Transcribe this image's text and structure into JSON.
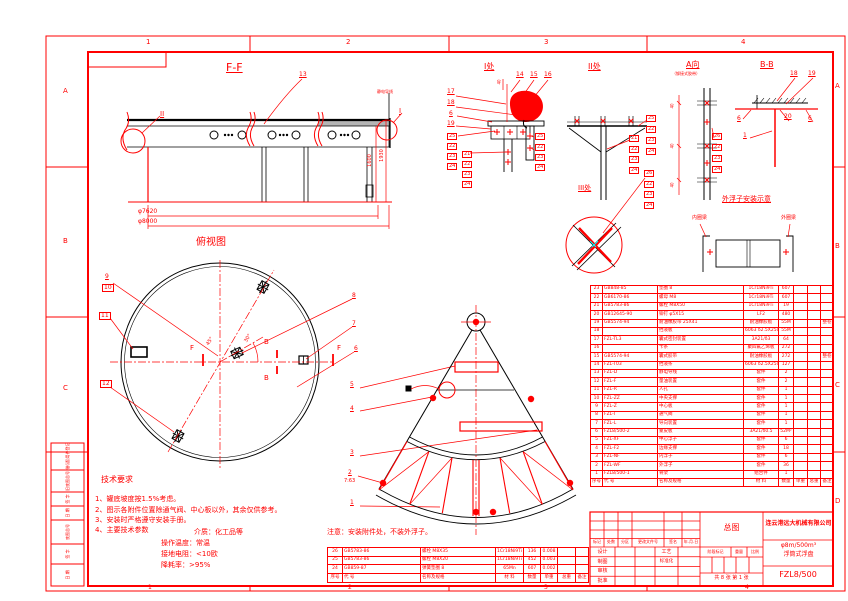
{
  "sheet": {
    "zones_top": [
      "1",
      "2",
      "3",
      "4"
    ],
    "zones_bottom": [
      "1",
      "2",
      "3",
      "4"
    ],
    "zones_left": [
      "A",
      "B",
      "C"
    ],
    "zones_right": [
      "A",
      "B",
      "C",
      "D"
    ],
    "left_strip": [
      "借(通)用件登记",
      "旧底图总号",
      "签 字",
      "日 期",
      "底图总号",
      "签 字",
      "日 期"
    ]
  },
  "views": {
    "ff": {
      "title": "F-F",
      "c13": "13",
      "cII": "II",
      "cI": "I",
      "wire": "静电导线",
      "dim1600": "1600",
      "dim1930": "1930",
      "dia7620": "φ7620",
      "dia8000": "φ8000"
    },
    "plan": {
      "title": "俯视图",
      "c9": "9",
      "c10": "10",
      "c11": "11",
      "c12": "12",
      "c8": "8",
      "c7": "7",
      "c6": "6",
      "c5": "5",
      "c4": "4",
      "c3": "3",
      "c2": "2",
      "c2sub": "7:63",
      "c1": "1",
      "f": "F",
      "b": "B",
      "a30": "30°",
      "a45": "45°"
    },
    "d1": {
      "title": "I处",
      "dim40": "40",
      "c14": "14",
      "c15": "15",
      "c16": "16",
      "c17": "17",
      "c18": "18",
      "c6": "6",
      "c19": "19",
      "sL": [
        "25",
        "22",
        "23",
        "24"
      ],
      "sM": [
        "21",
        "22",
        "23",
        "24"
      ],
      "sR": [
        "25",
        "22",
        "23",
        "24"
      ]
    },
    "d2": {
      "title": "II处",
      "sA": [
        "25",
        "22",
        "23",
        "24"
      ],
      "sB": [
        "21",
        "22",
        "23",
        "24"
      ]
    },
    "d3": {
      "title": "III处",
      "s": [
        "26",
        "22",
        "23",
        "24"
      ]
    },
    "da": {
      "title": "A向",
      "subtitle": "（铆接式胶带）",
      "dim40": "40",
      "s": [
        "26",
        "22",
        "23",
        "24"
      ]
    },
    "bb": {
      "title": "B-B",
      "c18": "18",
      "c19": "19",
      "c6a": "6",
      "c20": "20",
      "c6b": "6",
      "c1": "1"
    },
    "fl": {
      "title": "外浮子安装示意",
      "inner": "内圈梁",
      "outer": "外圈梁"
    }
  },
  "tech": {
    "heading": "技术要求",
    "items": [
      "1、罐底坡度按1.5%考虑。",
      "2、图示各附件位置除通气阀、中心板以外，其余仅供参考。",
      "3、安装时严格遵守安装手册。",
      "4、主要技术参数"
    ],
    "params": [
      "介质：化工品等",
      "操作温度：常温",
      "接地电阻：<10欧",
      "降耗率：>95%"
    ]
  },
  "note": "注意：安装附件处，不装外浮子。",
  "bom": {
    "headers": [
      "序号",
      "代  号",
      "名称及规格",
      "材  料",
      "数量",
      "单重",
      "总重",
      "备注"
    ],
    "rows": [
      [
        "23",
        "GB848-85",
        "垫圈 8",
        "1Cr18Ni9Ti",
        "607",
        "",
        "",
        ""
      ],
      [
        "22",
        "GB6170-86",
        "螺母 M8",
        "1Cr18Ni9Ti",
        "607",
        "",
        "",
        ""
      ],
      [
        "21",
        "GB5783-86",
        "螺栓 M8X50",
        "1Cr18Ni9Ti",
        "19",
        "",
        "",
        ""
      ],
      [
        "20",
        "GB12645-90",
        "铆钉 φ5X15",
        "LF2",
        "480",
        "",
        "",
        ""
      ],
      [
        "19",
        "GB5574-94",
        "耐油橡胶带 25X41",
        "耐油橡胶板",
        "55M",
        "",
        "",
        "整卷"
      ],
      [
        "18",
        "",
        "挡液板",
        "6063 δ2.5X250",
        "55M",
        "",
        "",
        ""
      ],
      [
        "17",
        "FZL-TL3",
        "囊式密封装置",
        "3A21/δ3",
        "64",
        "",
        "",
        ""
      ],
      [
        "16",
        "",
        "卡条",
        "聚四氟乙烯板",
        "272",
        "",
        "",
        ""
      ],
      [
        "15",
        "GB5574-94",
        "囊式胶带",
        "耐油橡胶板",
        "272",
        "",
        "",
        "整卷"
      ],
      [
        "14",
        "FZL-T03",
        "挡液条",
        "6063 δ2.5X250",
        "127",
        "",
        "",
        ""
      ],
      [
        "13",
        "FZL-D",
        "静电导线",
        "套件",
        "2",
        "",
        "",
        ""
      ],
      [
        "12",
        "FZL-F",
        "量油装置",
        "套件",
        "2",
        "",
        "",
        ""
      ],
      [
        "11",
        "FZL-R",
        "人孔",
        "套件",
        "1",
        "",
        "",
        ""
      ],
      [
        "10",
        "FZL-ZZ",
        "中央支撑",
        "套件",
        "1",
        "",
        "",
        ""
      ],
      [
        "9",
        "FZL-Z",
        "中心板",
        "套件",
        "1",
        "",
        "",
        ""
      ],
      [
        "8",
        "FZL-T",
        "通气阀",
        "套件",
        "1",
        "",
        "",
        ""
      ],
      [
        "7",
        "FZL-L",
        "导向装置",
        "套件",
        "1",
        "",
        "",
        ""
      ],
      [
        "6",
        "FZL8/500-2",
        "蒙皮板",
        "3A21/δ0.5",
        "52M²",
        "",
        "",
        ""
      ],
      [
        "5",
        "FZL-XF",
        "中心浮子",
        "套件",
        "6",
        "",
        "",
        ""
      ],
      [
        "4",
        "FZL-F2",
        "边缘支撑",
        "套件",
        "18",
        "",
        "",
        ""
      ],
      [
        "3",
        "FZL-NF",
        "内浮子",
        "套件",
        "6",
        "",
        "",
        ""
      ],
      [
        "2",
        "FZL-WF",
        "外浮子",
        "套件",
        "36",
        "",
        "",
        ""
      ],
      [
        "1",
        "FZL8/500-1",
        "骨架",
        "组合件",
        "1",
        "",
        "",
        ""
      ]
    ]
  },
  "bom2": {
    "headers": [
      "序号",
      "代  号",
      "名称及规格",
      "材  料",
      "数量",
      "单重",
      "总重",
      "备注"
    ],
    "rows": [
      [
        "26",
        "GB5783-86",
        "螺栓 M8X35",
        "1Cr18Ni9Ti",
        "136",
        "0.008",
        "",
        ""
      ],
      [
        "25",
        "GB5783-86",
        "螺栓 M8X20",
        "1Cr18Ni9Ti",
        "452",
        "0.003",
        "",
        ""
      ],
      [
        "24",
        "GB859-87",
        "弹簧垫圈 8",
        "65Mn",
        "607",
        "0.002",
        "",
        ""
      ]
    ]
  },
  "titleblock": {
    "rev_headers": [
      "标记",
      "处数",
      "分区",
      "更改文件号",
      "签名",
      "年.月.日"
    ],
    "sig_left": [
      "设计",
      "制图",
      "审核",
      "批准"
    ],
    "sig_right": [
      "工艺",
      "标准化"
    ],
    "drawing_title": "总图",
    "stage_label": "阶段标记",
    "weight_label": "重量",
    "scale_label": "比例",
    "sheet_info": "共 8 张 第 1 张",
    "company": "连云港远大机械有限公司",
    "product_spec": "φ8m/500m³",
    "product_name": "浮筒式浮盘",
    "drawing_no": "FZL8/500"
  }
}
